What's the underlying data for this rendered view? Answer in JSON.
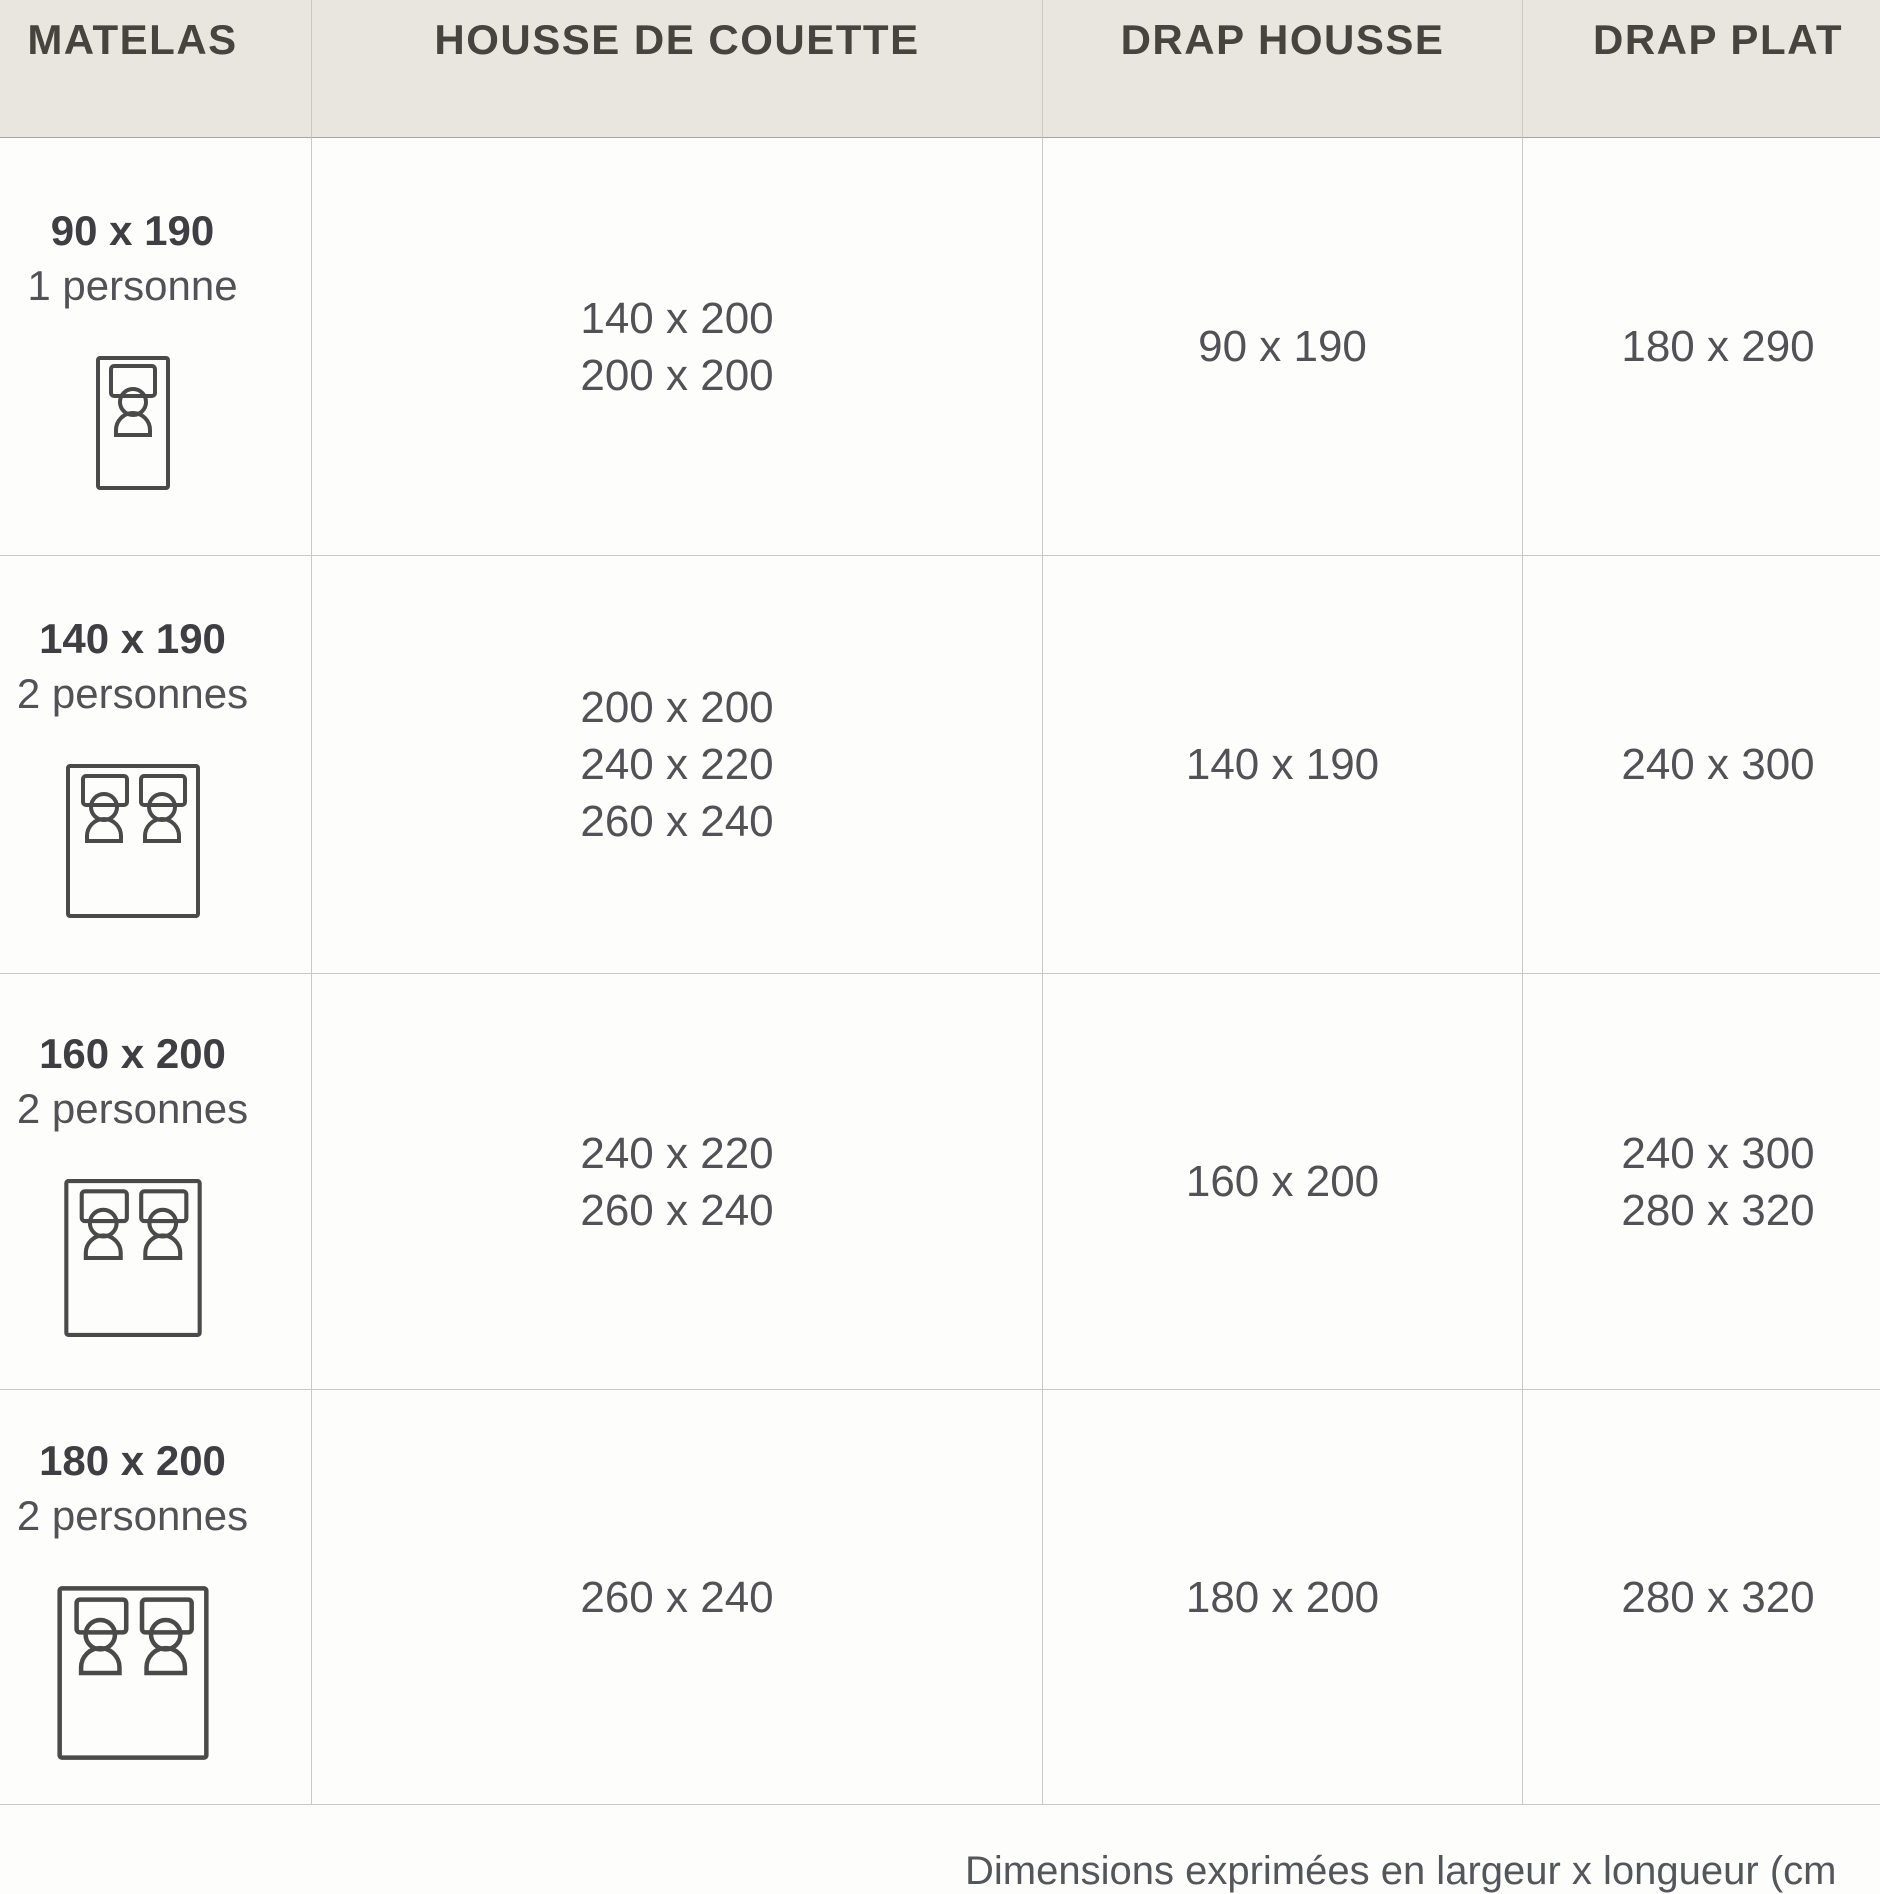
{
  "header": {
    "columns": [
      "MATELAS",
      "HOUSSE DE COUETTE",
      "DRAP HOUSSE",
      "DRAP PLAT"
    ]
  },
  "rows": [
    {
      "matelas_size": "90 x 190",
      "matelas_capacity": "1 personne",
      "bed_icon": "single-bed-icon",
      "housse_de_couette": [
        "140 x 200",
        "200 x 200"
      ],
      "drap_housse": [
        "90 x 190"
      ],
      "drap_plat": [
        "180 x 290"
      ]
    },
    {
      "matelas_size": "140 x 190",
      "matelas_capacity": "2 personnes",
      "bed_icon": "double-bed-icon",
      "housse_de_couette": [
        "200 x 200",
        "240 x 220",
        "260 x 240"
      ],
      "drap_housse": [
        "140 x 190"
      ],
      "drap_plat": [
        "240 x 300"
      ]
    },
    {
      "matelas_size": "160 x 200",
      "matelas_capacity": "2 personnes",
      "bed_icon": "double-bed-icon",
      "housse_de_couette": [
        "240 x 220",
        "260 x 240"
      ],
      "drap_housse": [
        "160 x 200"
      ],
      "drap_plat": [
        "240 x 300",
        "280 x 320"
      ]
    },
    {
      "matelas_size": "180 x 200",
      "matelas_capacity": "2 personnes",
      "bed_icon": "double-bed-icon",
      "housse_de_couette": [
        "260 x 240"
      ],
      "drap_housse": [
        "180 x 200"
      ],
      "drap_plat": [
        "280 x 320"
      ]
    }
  ],
  "footer": {
    "note": "Dimensions exprimées en largeur x longueur (cm"
  },
  "colors": {
    "header_bg": "#e9e5df",
    "header_text": "#474440",
    "body_text": "#515156",
    "size_text": "#3e3e43",
    "border": "#c9c9c9",
    "header_border": "#aaa7a3",
    "icon_stroke": "#4a4a4a",
    "page_bg": "#fdfdfc",
    "footer_text": "#55565b"
  }
}
